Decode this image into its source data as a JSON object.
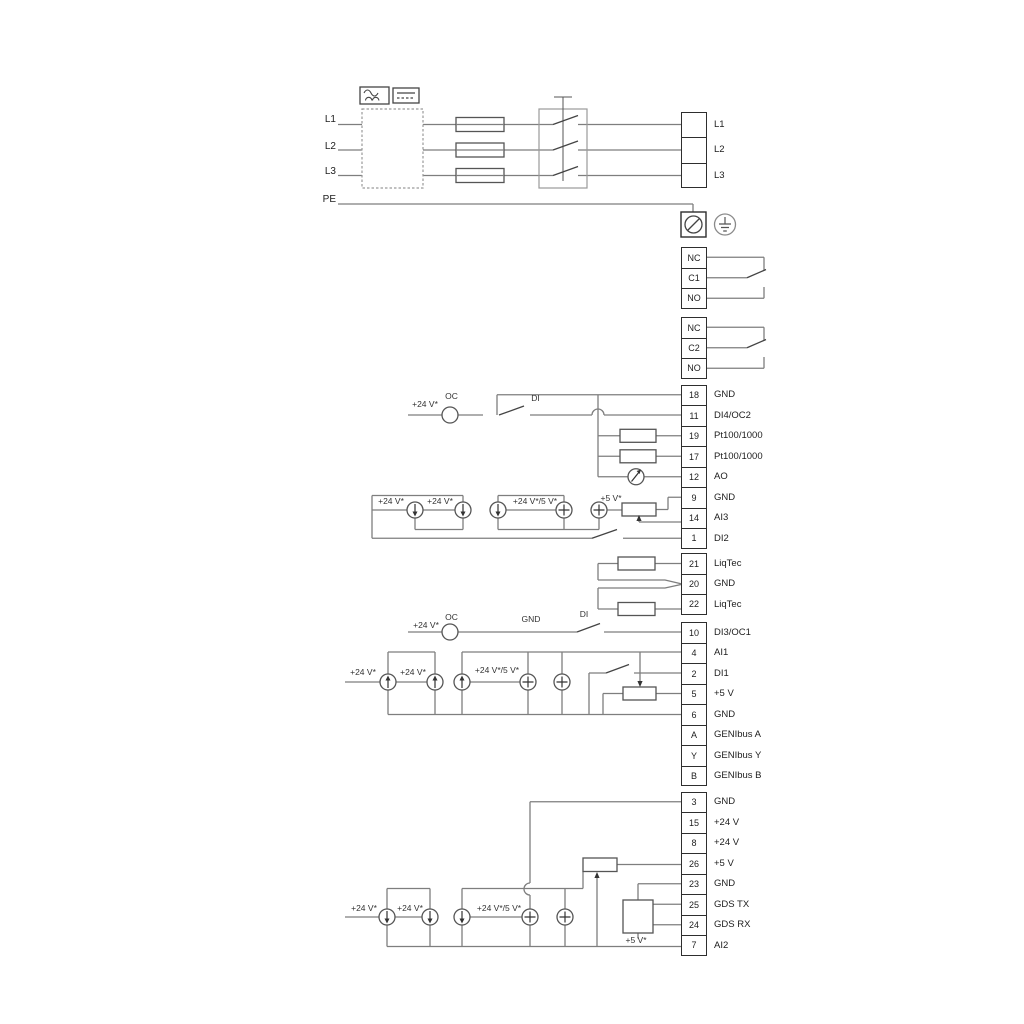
{
  "power_in": {
    "l1": "L1",
    "l2": "L2",
    "l3": "L3",
    "pe": "PE"
  },
  "labels": {
    "plus24": "+24 V*",
    "plus24or5": "+24 V*/5 V*",
    "plus5": "+5 V*",
    "oc": "OC",
    "di": "DI",
    "gnd": "GND"
  },
  "terminals": {
    "mains": [
      {
        "num": "",
        "label": "L1"
      },
      {
        "num": "",
        "label": "L2"
      },
      {
        "num": "",
        "label": "L3"
      }
    ],
    "relay1": [
      {
        "num": "NC",
        "label": ""
      },
      {
        "num": "C1",
        "label": ""
      },
      {
        "num": "NO",
        "label": ""
      }
    ],
    "relay2": [
      {
        "num": "NC",
        "label": ""
      },
      {
        "num": "C2",
        "label": ""
      },
      {
        "num": "NO",
        "label": ""
      }
    ],
    "io1": [
      {
        "num": "18",
        "label": "GND"
      },
      {
        "num": "11",
        "label": "DI4/OC2"
      },
      {
        "num": "19",
        "label": "Pt100/1000"
      },
      {
        "num": "17",
        "label": "Pt100/1000"
      },
      {
        "num": "12",
        "label": "AO"
      },
      {
        "num": "9",
        "label": "GND"
      },
      {
        "num": "14",
        "label": "AI3"
      },
      {
        "num": "1",
        "label": "DI2"
      }
    ],
    "liqtec": [
      {
        "num": "21",
        "label": "LiqTec"
      },
      {
        "num": "20",
        "label": "GND"
      },
      {
        "num": "22",
        "label": "LiqTec"
      }
    ],
    "io2": [
      {
        "num": "10",
        "label": "DI3/OC1"
      },
      {
        "num": "4",
        "label": "AI1"
      },
      {
        "num": "2",
        "label": "DI1"
      },
      {
        "num": "5",
        "label": "+5 V"
      },
      {
        "num": "6",
        "label": "GND"
      },
      {
        "num": "A",
        "label": "GENIbus A"
      },
      {
        "num": "Y",
        "label": "GENIbus Y"
      },
      {
        "num": "B",
        "label": "GENIbus B"
      }
    ],
    "io3": [
      {
        "num": "3",
        "label": "GND"
      },
      {
        "num": "15",
        "label": "+24 V"
      },
      {
        "num": "8",
        "label": "+24 V"
      },
      {
        "num": "26",
        "label": "+5 V"
      },
      {
        "num": "23",
        "label": "GND"
      },
      {
        "num": "25",
        "label": "GDS TX"
      },
      {
        "num": "24",
        "label": "GDS RX"
      },
      {
        "num": "7",
        "label": "AI2"
      }
    ]
  }
}
